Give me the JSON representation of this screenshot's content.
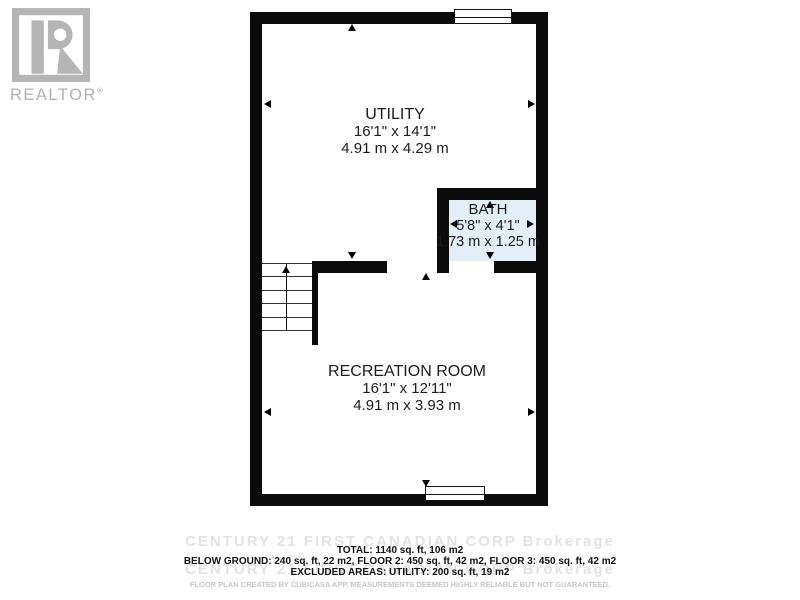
{
  "logo": {
    "brand": "REALTOR",
    "trademark": "®",
    "icon": "realtor-r-logo"
  },
  "floorplan": {
    "rooms": [
      {
        "name": "UTILITY",
        "imperial": "16'1\" x 14'1\"",
        "metric": "4.91 m x 4.29 m"
      },
      {
        "name": "BATH",
        "imperial": "5'8\" x 4'1\"",
        "metric": "1.73 m x 1.25 m"
      },
      {
        "name": "RECREATION ROOM",
        "imperial": "16'1\" x 12'11\"",
        "metric": "4.91 m x 3.93 m"
      }
    ],
    "features": [
      "stairs-up",
      "window-top",
      "window-bottom"
    ]
  },
  "footer": {
    "watermark_line1": "CENTURY 21 FIRST CANADIAN CORP Brokerage",
    "watermark_line2": "CENTURY 21 FIRST CANADIAN CORP Brokerage",
    "total": "TOTAL: 1140 sq. ft, 106 m2",
    "floor_breakdown": "BELOW GROUND: 240 sq. ft, 22 m2, FLOOR 2: 450 sq. ft, 42 m2, FLOOR 3: 450 sq. ft, 42 m2",
    "excluded_areas": "EXCLUDED AREAS: UTILITY: 200 sq. ft, 19 m2",
    "disclaimer": "FLOOR PLAN CREATED BY CUBICASA APP. MEASUREMENTS DEEMED HIGHLY RELIABLE BUT NOT GUARANTEED."
  },
  "colors": {
    "wall": "#0b0b0b",
    "bath_fill": "#e4eef8",
    "logo_gray": "#b2b2b2",
    "watermark_gray": "#e3e3e3",
    "disclaimer_gray": "#c6c6c6",
    "label_text": "#1c1c1c"
  }
}
